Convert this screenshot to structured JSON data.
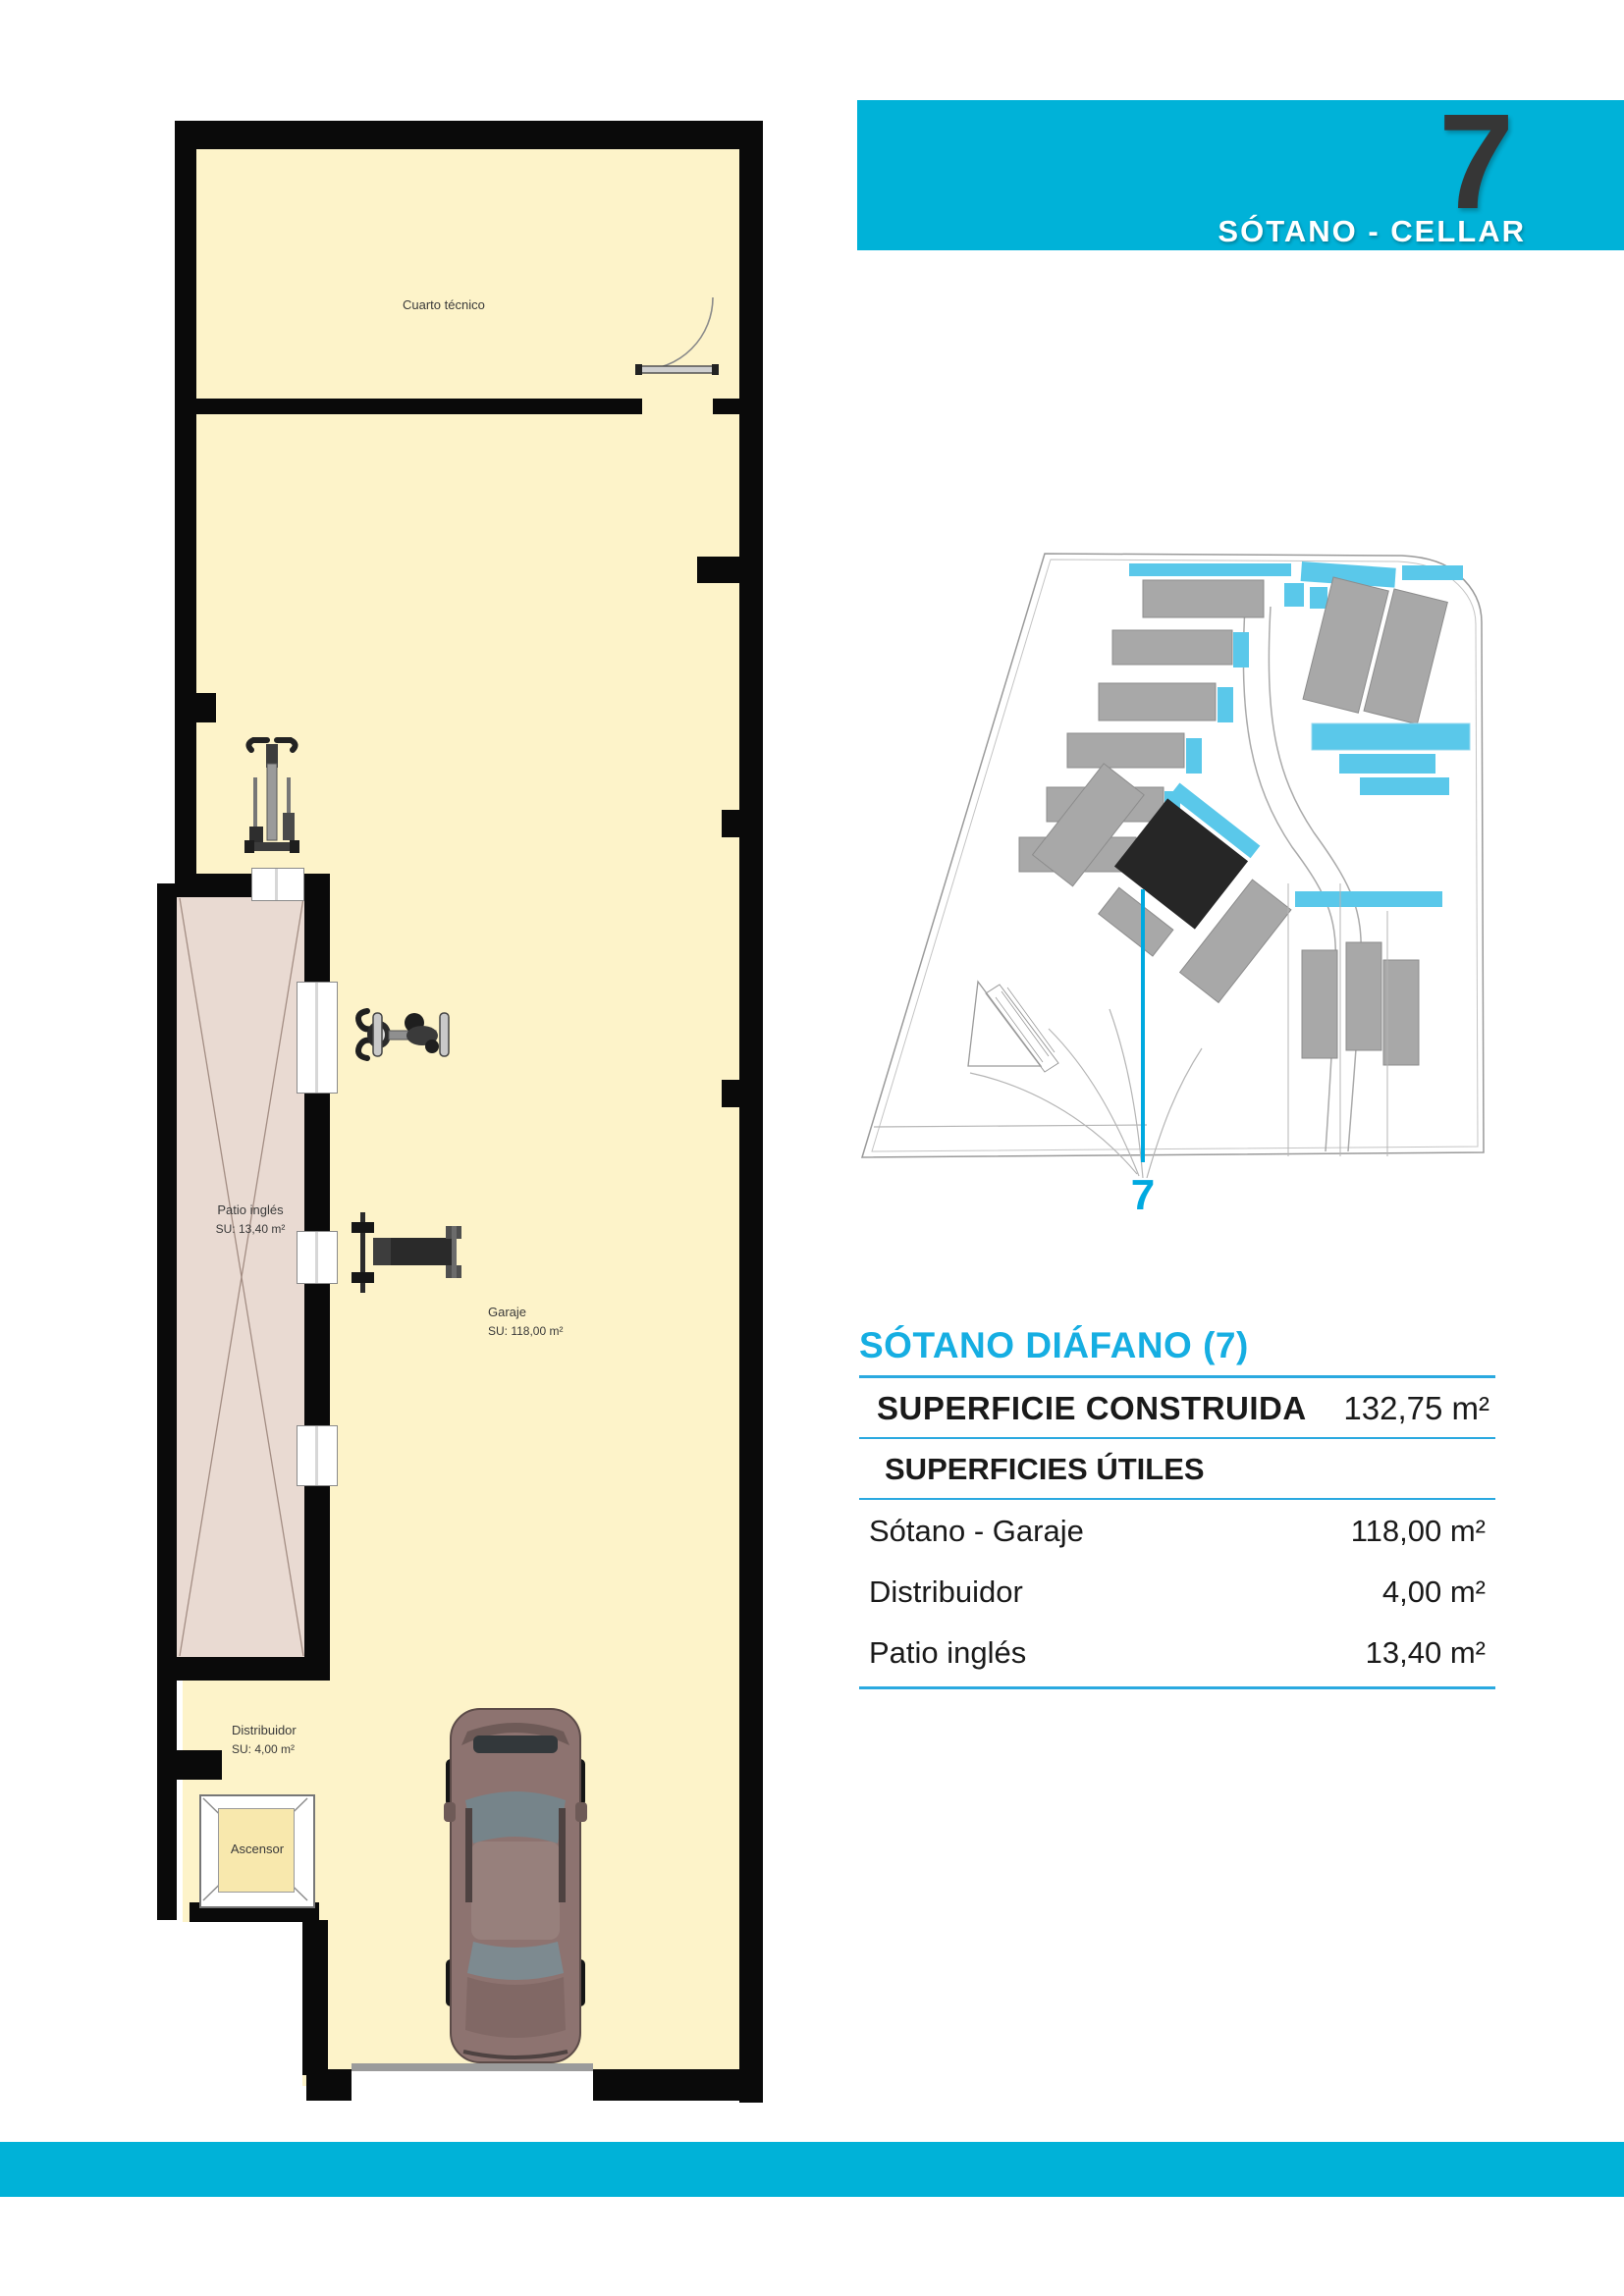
{
  "header": {
    "number": "7",
    "subtitle": "SÓTANO - CELLAR"
  },
  "floorplan": {
    "cuarto_tecnico": {
      "name": "Cuarto técnico"
    },
    "patio": {
      "name": "Patio inglés",
      "su": "SU: 13,40 m²"
    },
    "garaje": {
      "name": "Garaje",
      "su": "SU: 118,00 m²"
    },
    "distribuidor": {
      "name": "Distribuidor",
      "su": "SU: 4,00 m²"
    },
    "ascensor": {
      "name": "Ascensor"
    }
  },
  "siteplan": {
    "unit_marker": "7"
  },
  "table": {
    "title": "SÓTANO DIÁFANO (7)",
    "constructed_label": "SUPERFICIE CONSTRUIDA",
    "constructed_value": "132,75 m²",
    "useful_label": "SUPERFICIES ÚTILES",
    "rows": [
      {
        "label": "Sótano - Garaje",
        "value": "118,00 m²"
      },
      {
        "label": "Distribuidor",
        "value": "4,00 m²"
      },
      {
        "label": "Patio inglés",
        "value": "13,40 m²"
      }
    ]
  },
  "colors": {
    "accent_cyan": "#00b2d8",
    "title_cyan": "#16aee2",
    "pool_cyan": "#5ac8ea",
    "floor_cream": "#fdf3c9",
    "patio_pink": "#e9dad2",
    "wall_black": "#0a0a0a",
    "building_gray": "#a8a8a8"
  }
}
